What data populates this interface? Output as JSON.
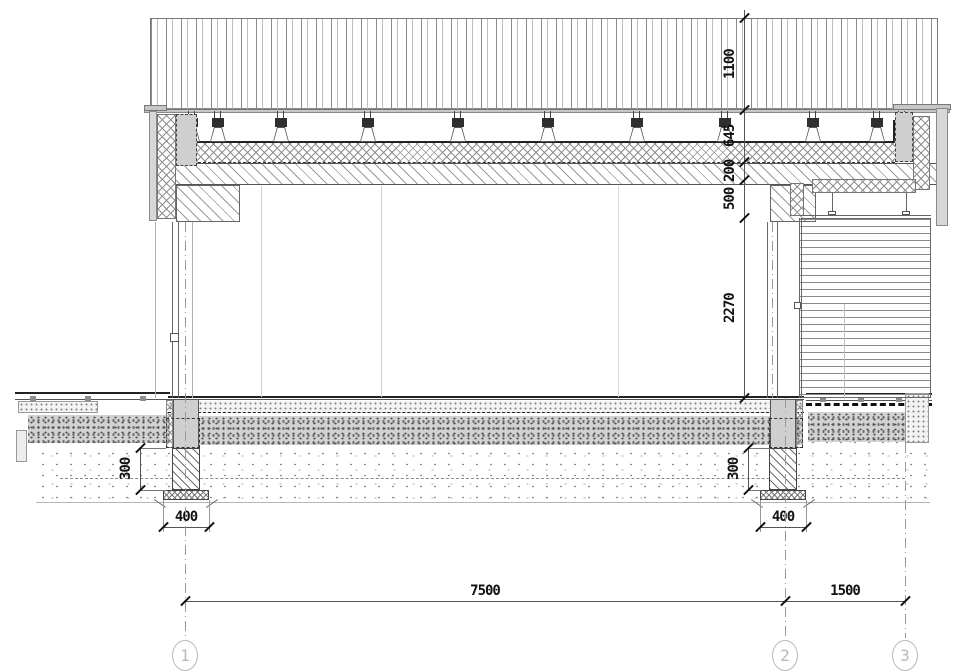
{
  "dimensions": {
    "vertical_chain": [
      "1100",
      "645",
      "200",
      "500",
      "2270"
    ],
    "foundation_left": {
      "depth": "300",
      "width": "400"
    },
    "foundation_right": {
      "depth": "300",
      "width": "400"
    },
    "spans": {
      "bay_1_2": "7500",
      "bay_2_3": "1500"
    }
  },
  "grid_axes": [
    "1",
    "2",
    "3"
  ],
  "colors": {
    "linework": "#444444",
    "concrete_fill": "#cfcfcf",
    "axis_bubble": "#b9b9b9",
    "dim_text": "#111111"
  }
}
